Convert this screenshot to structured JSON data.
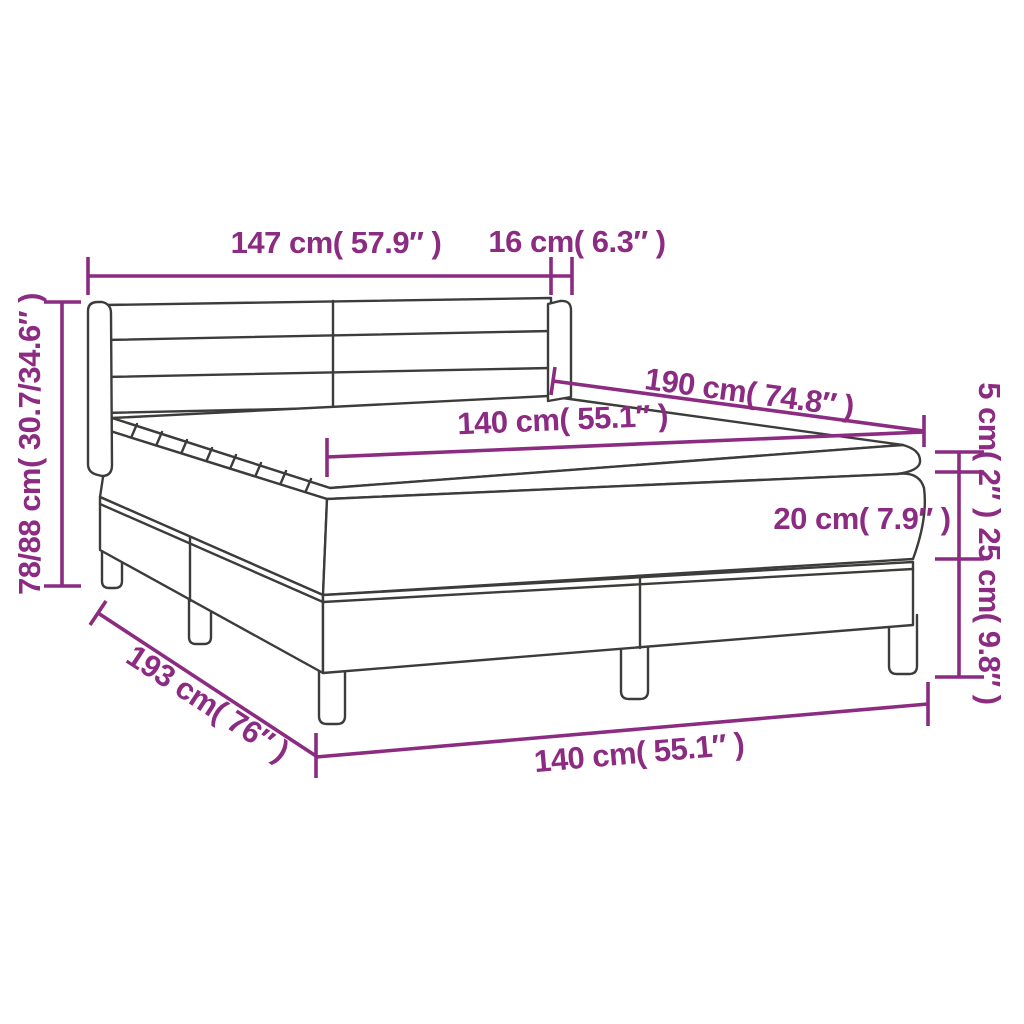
{
  "figure": {
    "subject": "box-spring-bed-dimension-diagram",
    "colors": {
      "dimension": "#8C2B82",
      "line_art": "#3C3C3B",
      "background": "#FFFFFF"
    }
  },
  "dims": {
    "headboard_width": {
      "cm": "147",
      "inch": "57.9",
      "label": "147 cm( 57.9″ )"
    },
    "headboard_side_depth": {
      "cm": "16",
      "inch": "6.3",
      "label": "16 cm( 6.3″ )"
    },
    "total_height": {
      "cm": "78/88",
      "inch": "30.7/34.6",
      "label": "78/88 cm( 30.7/34.6″ )"
    },
    "sleeping_length": {
      "cm": "190",
      "inch": "74.8",
      "label": "190 cm( 74.8″ )"
    },
    "sleeping_width": {
      "cm": "140",
      "inch": "55.1",
      "label": "140 cm( 55.1″ )"
    },
    "topper_height": {
      "cm": "5",
      "inch": "2",
      "label": "5 cm( 2″ )"
    },
    "mattress_height": {
      "cm": "20",
      "inch": "7.9",
      "label": "20 cm( 7.9″ )"
    },
    "base_height": {
      "cm": "25",
      "inch": "9.8",
      "label": "25 cm( 9.8″ )"
    },
    "base_length": {
      "cm": "193",
      "inch": "76",
      "label": "193 cm( 76″ )"
    },
    "base_width": {
      "cm": "140",
      "inch": "55.1",
      "label": "140 cm( 55.1″ )"
    }
  }
}
